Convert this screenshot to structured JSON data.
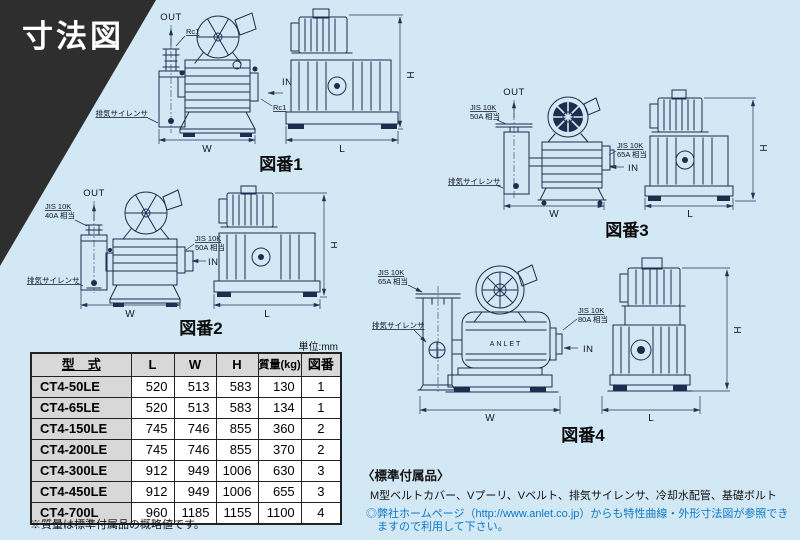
{
  "page": {
    "title": "寸法図",
    "unit_label": "単位:mm"
  },
  "figures": [
    {
      "caption": "図番1",
      "out_label": "OUT",
      "in_label": "IN",
      "out_port_l1": "Rc1",
      "in_port_l1": "Rc1",
      "silencer_label": "排気サイレンサ",
      "dim_w": "W",
      "dim_l": "L",
      "dim_h": "H"
    },
    {
      "caption": "図番2",
      "out_label": "OUT",
      "in_label": "IN",
      "out_port_l1": "JIS 10K",
      "out_port_l2": "40A 相当",
      "in_port_l1": "JIS 10K",
      "in_port_l2": "50A 相当",
      "silencer_label": "排気サイレンサ",
      "dim_w": "W",
      "dim_l": "L",
      "dim_h": "H"
    },
    {
      "caption": "図番3",
      "out_label": "OUT",
      "in_label": "IN",
      "out_port_l1": "JIS 10K",
      "out_port_l2": "50A 相当",
      "in_port_l1": "JIS 10K",
      "in_port_l2": "65A 相当",
      "silencer_label": "排気サイレンサ",
      "dim_w": "W",
      "dim_l": "L",
      "dim_h": "H"
    },
    {
      "caption": "図番4",
      "in_label": "IN",
      "out_port_l1": "JIS 10K",
      "out_port_l2": "65A 相当",
      "in_port_l1": "JIS 10K",
      "in_port_l2": "80A 相当",
      "silencer_label": "排気サイレンサ",
      "brand": "ANLET",
      "dim_w": "W",
      "dim_l": "L",
      "dim_h": "H"
    }
  ],
  "table": {
    "headers": {
      "model": "型　式",
      "l": "L",
      "w": "W",
      "h": "H",
      "mass": "質量(kg)",
      "fig": "図番"
    },
    "rows": [
      {
        "model": "CT4-50LE",
        "l": "520",
        "w": "513",
        "h": "583",
        "mass": "130",
        "fig": "1"
      },
      {
        "model": "CT4-65LE",
        "l": "520",
        "w": "513",
        "h": "583",
        "mass": "134",
        "fig": "1"
      },
      {
        "model": "CT4-150LE",
        "l": "745",
        "w": "746",
        "h": "855",
        "mass": "360",
        "fig": "2"
      },
      {
        "model": "CT4-200LE",
        "l": "745",
        "w": "746",
        "h": "855",
        "mass": "370",
        "fig": "2"
      },
      {
        "model": "CT4-300LE",
        "l": "912",
        "w": "949",
        "h": "1006",
        "mass": "630",
        "fig": "3"
      },
      {
        "model": "CT4-450LE",
        "l": "912",
        "w": "949",
        "h": "1006",
        "mass": "655",
        "fig": "3"
      },
      {
        "model": "CT4-700L",
        "l": "960",
        "w": "1185",
        "h": "1155",
        "mass": "1100",
        "fig": "4"
      }
    ],
    "mass_note": "※質量は標準付属品の概略値です。"
  },
  "notes": {
    "accessories_title": "〈標準付属品〉",
    "accessories_body": "M型ベルトカバー、Vプーリ、Vベルト、排気サイレンサ、冷却水配管、基礎ボルト",
    "homepage_note_l1": "◎弊社ホームページ（http://www.anlet.co.jp）からも特性曲線・外形寸法図が参照でき",
    "homepage_note_l2": "ますので利用して下さい。"
  }
}
